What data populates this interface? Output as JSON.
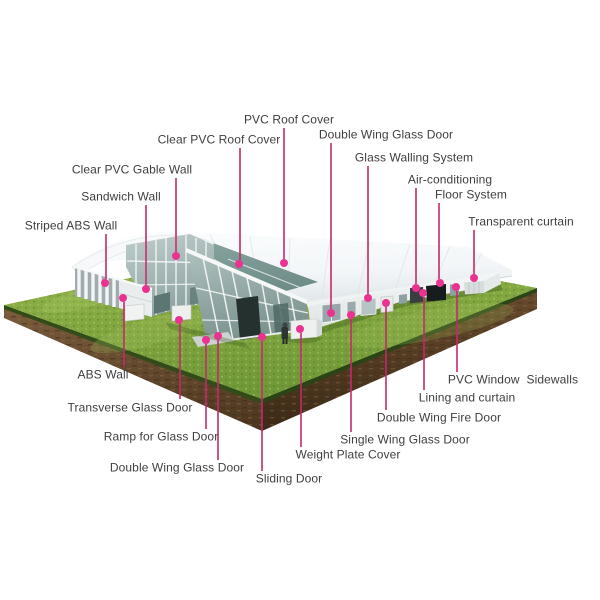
{
  "scene": {
    "alt": "3D rendering of an aluminium-frame event marquee tent with curved white roof, glass gable walls and side doors, standing on a rectangular grass plot with soil edges; twenty parts are annotated with pink leader lines and dots"
  },
  "colors": {
    "background": "#ffffff",
    "leader_line": "#c5296b",
    "dot": "#ea3390",
    "label_text": "#3e3e3e",
    "grass": "#84a845",
    "soil": "#6b4d30",
    "roof_white": "#f7f9fa",
    "glass_teal": "#9cb1af"
  },
  "callouts": [
    {
      "id": "pvc-roof-cover",
      "text": "PVC Roof Cover",
      "label": {
        "x": 289,
        "y": 120
      },
      "line": {
        "x": 284,
        "y1": 128,
        "y2": 259
      },
      "dot": {
        "x": 284,
        "y": 263
      }
    },
    {
      "id": "clear-pvc-roof-cover",
      "text": "Clear PVC Roof Cover",
      "label": {
        "x": 219,
        "y": 140
      },
      "line": {
        "x": 240,
        "y1": 148,
        "y2": 260
      },
      "dot": {
        "x": 239,
        "y": 264
      }
    },
    {
      "id": "double-wing-glass-door-right",
      "text": "Double Wing Glass Door",
      "label": {
        "x": 386,
        "y": 135
      },
      "line": {
        "x": 331,
        "y1": 143,
        "y2": 309
      },
      "dot": {
        "x": 331,
        "y": 313
      }
    },
    {
      "id": "glass-walling-system",
      "text": "Glass Walling System",
      "label": {
        "x": 414,
        "y": 158
      },
      "line": {
        "x": 368,
        "y1": 166,
        "y2": 294
      },
      "dot": {
        "x": 368,
        "y": 298
      }
    },
    {
      "id": "air-conditioning",
      "text": "Air-conditioning",
      "label": {
        "x": 450,
        "y": 180
      },
      "line": {
        "x": 416,
        "y1": 188,
        "y2": 284
      },
      "dot": {
        "x": 416,
        "y": 288
      }
    },
    {
      "id": "floor-system",
      "text": "Floor System",
      "label": {
        "x": 471,
        "y": 195
      },
      "line": {
        "x": 439,
        "y1": 203,
        "y2": 279
      },
      "dot": {
        "x": 440,
        "y": 283
      }
    },
    {
      "id": "transparent-curtain",
      "text": "Transparent curtain",
      "label": {
        "x": 521,
        "y": 222
      },
      "line": {
        "x": 474,
        "y1": 230,
        "y2": 274
      },
      "dot": {
        "x": 474,
        "y": 278
      }
    },
    {
      "id": "clear-pvc-gable-wall",
      "text": "Clear PVC Gable Wall",
      "label": {
        "x": 132,
        "y": 170
      },
      "line": {
        "x": 176,
        "y1": 178,
        "y2": 252
      },
      "dot": {
        "x": 176,
        "y": 256
      }
    },
    {
      "id": "sandwich-wall",
      "text": "Sandwich Wall",
      "label": {
        "x": 121,
        "y": 197
      },
      "line": {
        "x": 146,
        "y1": 205,
        "y2": 285
      },
      "dot": {
        "x": 146,
        "y": 289
      }
    },
    {
      "id": "striped-abs-wall",
      "text": "Striped ABS Wall",
      "label": {
        "x": 71,
        "y": 226
      },
      "line": {
        "x": 106,
        "y1": 234,
        "y2": 279
      },
      "dot": {
        "x": 105,
        "y": 283
      }
    },
    {
      "id": "abs-wall",
      "text": "ABS Wall",
      "label": {
        "x": 103,
        "y": 375
      },
      "line": {
        "x": 124,
        "y1": 302,
        "y2": 367
      },
      "dot": {
        "x": 123,
        "y": 298
      }
    },
    {
      "id": "transverse-glass-door",
      "text": "Transverse Glass Door",
      "label": {
        "x": 130,
        "y": 408
      },
      "line": {
        "x": 180,
        "y1": 324,
        "y2": 399
      },
      "dot": {
        "x": 179,
        "y": 320
      }
    },
    {
      "id": "ramp-for-glass-door",
      "text": "Ramp for Glass Door",
      "label": {
        "x": 161,
        "y": 437
      },
      "line": {
        "x": 206,
        "y1": 344,
        "y2": 429
      },
      "dot": {
        "x": 206,
        "y": 340
      }
    },
    {
      "id": "double-wing-glass-door-front",
      "text": "Double Wing Glass Door",
      "label": {
        "x": 177,
        "y": 468
      },
      "line": {
        "x": 218,
        "y1": 340,
        "y2": 460
      },
      "dot": {
        "x": 218,
        "y": 336
      }
    },
    {
      "id": "sliding-door",
      "text": "Sliding Door",
      "label": {
        "x": 289,
        "y": 479
      },
      "line": {
        "x": 262,
        "y1": 341,
        "y2": 471
      },
      "dot": {
        "x": 262,
        "y": 337
      }
    },
    {
      "id": "weight-plate-cover",
      "text": "Weight Plate Cover",
      "label": {
        "x": 348,
        "y": 455
      },
      "line": {
        "x": 301,
        "y1": 333,
        "y2": 447
      },
      "dot": {
        "x": 300,
        "y": 329
      }
    },
    {
      "id": "single-wing-glass-door",
      "text": "Single Wing Glass Door",
      "label": {
        "x": 405,
        "y": 440
      },
      "line": {
        "x": 351,
        "y1": 319,
        "y2": 432
      },
      "dot": {
        "x": 351,
        "y": 315
      }
    },
    {
      "id": "double-wing-fire-door",
      "text": "Double Wing Fire Door",
      "label": {
        "x": 439,
        "y": 418
      },
      "line": {
        "x": 386,
        "y1": 307,
        "y2": 410
      },
      "dot": {
        "x": 386,
        "y": 303
      }
    },
    {
      "id": "lining-and-curtain",
      "text": "Lining and curtain",
      "label": {
        "x": 467,
        "y": 398
      },
      "line": {
        "x": 424,
        "y1": 297,
        "y2": 390
      },
      "dot": {
        "x": 423,
        "y": 293
      }
    },
    {
      "id": "pvc-window-sidewalls",
      "text": "PVC Window  Sidewalls",
      "label": {
        "x": 513,
        "y": 380
      },
      "line": {
        "x": 457,
        "y1": 291,
        "y2": 372
      },
      "dot": {
        "x": 456,
        "y": 287
      }
    }
  ]
}
